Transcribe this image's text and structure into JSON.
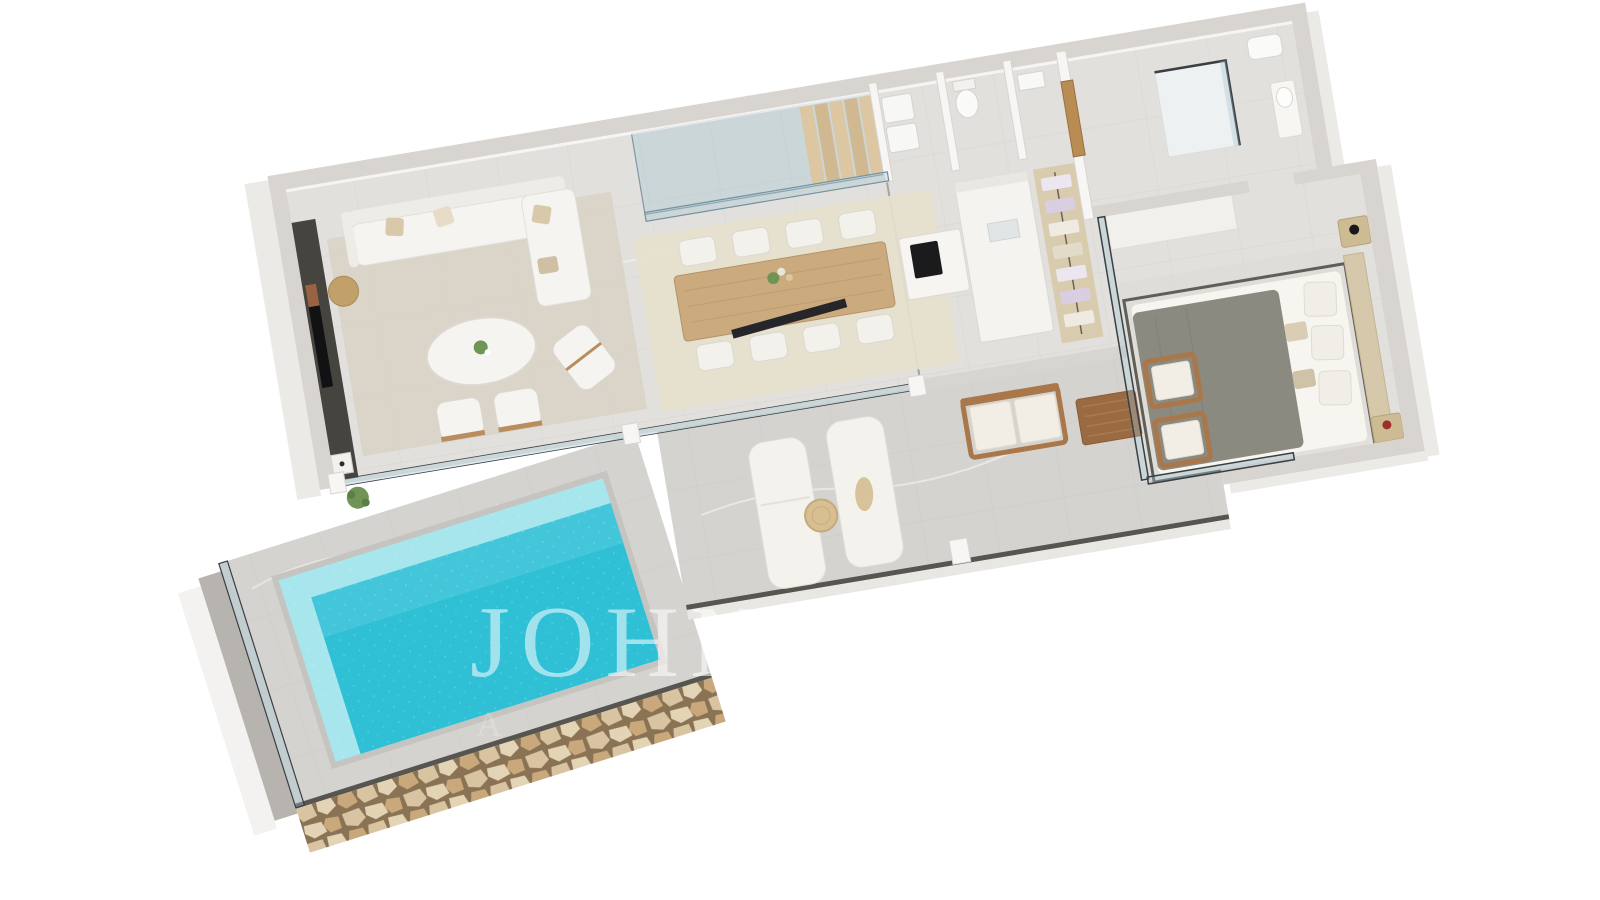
{
  "watermark": {
    "line1": "JOHN T",
    "line2": "A"
  },
  "scene": {
    "type": "3d-isometric-floor-plan-render",
    "style": "white architectural render, marble floors, turquoise pool, natural stone wall",
    "rooms": [
      {
        "name": "living-room",
        "furniture": [
          "corner-sofa",
          "chaise",
          "oval-coffee-table",
          "two-armchairs",
          "lounge-chair",
          "round-side-table",
          "tv-media-wall",
          "fireplace",
          "area-rug",
          "plant"
        ]
      },
      {
        "name": "dining-area",
        "furniture": [
          "wooden-dining-table",
          "eight-white-chairs",
          "flower-centerpiece",
          "area-rug"
        ]
      },
      {
        "name": "staircase",
        "furniture": [
          "glass-balustrade",
          "wooden-steps"
        ]
      },
      {
        "name": "kitchen",
        "furniture": [
          "island-with-black-cooktop",
          "white-counter"
        ]
      },
      {
        "name": "utility-rooms",
        "furniture": [
          "stacked-laundry-machines",
          "wc-toilet",
          "small-sink"
        ]
      },
      {
        "name": "hallway",
        "furniture": [
          "wooden-door",
          "walk-in-wardrobe-with-hanging-clothes"
        ]
      },
      {
        "name": "bathroom",
        "furniture": [
          "glass-shower",
          "vanity-basin",
          "wc"
        ]
      },
      {
        "name": "bedroom",
        "furniture": [
          "double-bed-grey-duvet",
          "wood-headboard-panel",
          "nightstand-with-black-lamp",
          "nightstand-with-red-vase",
          "area-rug",
          "glass-corner-window"
        ]
      },
      {
        "name": "terrace",
        "furniture": [
          "two-sun-loungers",
          "rolled-towel",
          "round-jute-table",
          "outdoor-wood-sofa",
          "outdoor-coffee-table",
          "two-outdoor-armchairs",
          "glass-pool-fence"
        ]
      },
      {
        "name": "pool",
        "furniture": []
      }
    ]
  },
  "colors": {
    "background": "#ffffff",
    "wall_band": "#d8d5d0",
    "wall_face": "#f7f6f4",
    "wall_outer": "#eceae6",
    "floor_interior": "#e2e0dc",
    "floor_terrace": "#d5d3cf",
    "tile_joint": "#c6c4c0",
    "rug_living": "#d9d3c6",
    "rug_dining": "#e7e0cd",
    "rug_bedroom": "#dedcd6",
    "sofa": "#f6f4f0",
    "cushion": "#d9c9ab",
    "wood_light": "#cbab7e",
    "wood_dark": "#a9774a",
    "stairs_wood": "#dcc7a2",
    "glass": "rgba(160,195,210,0.35)",
    "glass_frame": "#3a3f44",
    "media_wall": "#46443f",
    "cooktop": "#1b1b1d",
    "closet_floor": "#d9cbae",
    "door_wood": "#b98c54",
    "duvet": "#8b8a80",
    "sheet": "#f7f5f0",
    "headboard": "#d6c8ab",
    "bed_frame": "#4a4843",
    "accent_red": "#9e2f2f",
    "pool_deep": "#2fc0d6",
    "pool_light": "#a7e6ec",
    "coping": "#c6c4c0",
    "stone_joint": "#8a7354",
    "stone_a": "#d9c4a2",
    "stone_b": "#c9a97c",
    "stone_c": "#e4d4b6",
    "plant": "#6f9455",
    "lounger": "#f4f2ed",
    "towel": "#d8c29a",
    "watermark": "#ffffff"
  }
}
